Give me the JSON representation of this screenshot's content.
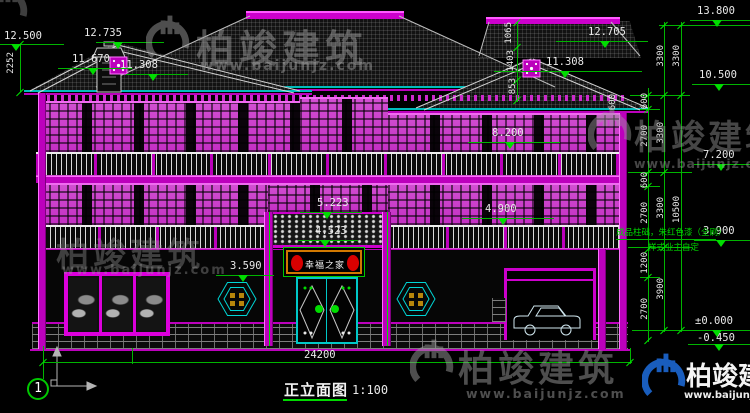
{
  "drawing": {
    "title": "正立面图",
    "scale": "1:100",
    "axis_label": "1",
    "sign_text": "幸福之家",
    "note_line1": "成品柱础，朱红色漆（全刷）",
    "note_line2": "样式业主自定"
  },
  "elevations": {
    "left_ridge": "12.500",
    "left_peak": "12.735",
    "left_a": "11.670",
    "left_b": "11.308",
    "right_peak": "12.705",
    "right_a": "11.308",
    "top": "13.800",
    "lv_10500": "10.500",
    "lv_7200": "7.200",
    "lv_3900": "3.900",
    "zero": "±0.000",
    "neg": "-0.450",
    "floor2": "8.200",
    "floor1": "4.900",
    "porch_ridge": "5.223",
    "porch_eave": "4.523",
    "window": "3.590"
  },
  "dimensions": {
    "left_height": "2252",
    "roof_a": "1065",
    "roof_b": "1403",
    "roof_c": "853",
    "eave_offset": "600",
    "inner": [
      "600",
      "2700",
      "600",
      "2700",
      "1200",
      "2700"
    ],
    "mid": [
      "3300",
      "3300",
      "3300",
      "3900"
    ],
    "outer_top": "3300",
    "overall_v": "10500",
    "overall_h": "24200"
  },
  "watermark": {
    "brand": "柏竣建筑",
    "url": "www.baijunjz.com"
  },
  "colors": {
    "accent_magenta": "#cc00cc",
    "accent_cyan": "#00c8c8",
    "accent_green": "#00dc00",
    "brand_blue": "#1b63c8"
  }
}
